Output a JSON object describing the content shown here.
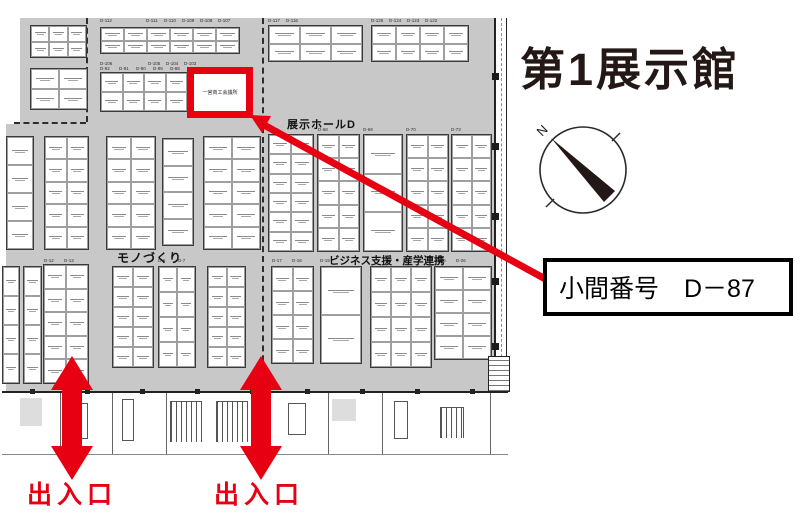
{
  "page": {
    "title": "第1展示館"
  },
  "compass": {
    "north_label": "N"
  },
  "callout": {
    "text": "小間番号　D－87"
  },
  "entrances": {
    "left_label": "出入口",
    "right_label": "出入口"
  },
  "aisles": {
    "hall_d": "展示ホールD",
    "monozukuri": "モノづくり",
    "business": "ビジネス支援・産学連携"
  },
  "highlighted_booth": {
    "number": "D－87",
    "name": "一宮商工会議所"
  },
  "colors": {
    "accent_red": "#e60012",
    "map_gray": "#c8c8c8",
    "ink": "#231815"
  },
  "map": {
    "groups": [
      {
        "x": 30,
        "y": 25,
        "w": 57,
        "h": 33,
        "c": 3,
        "r": 2
      },
      {
        "x": 30,
        "y": 68,
        "w": 58,
        "h": 42,
        "c": 2,
        "r": 2
      },
      {
        "x": 100,
        "y": 27,
        "w": 140,
        "h": 27,
        "c": 6,
        "r": 2
      },
      {
        "x": 100,
        "y": 72,
        "w": 88,
        "h": 40,
        "c": 4,
        "r": 2
      },
      {
        "x": 268,
        "y": 25,
        "w": 95,
        "h": 37,
        "c": 3,
        "r": 2
      },
      {
        "x": 371,
        "y": 25,
        "w": 98,
        "h": 37,
        "c": 4,
        "r": 2
      },
      {
        "x": 6,
        "y": 136,
        "w": 28,
        "h": 114,
        "c": 1,
        "r": 4
      },
      {
        "x": 44,
        "y": 136,
        "w": 45,
        "h": 114,
        "c": 2,
        "r": 5
      },
      {
        "x": 106,
        "y": 136,
        "w": 50,
        "h": 114,
        "c": 2,
        "r": 5
      },
      {
        "x": 162,
        "y": 138,
        "w": 32,
        "h": 108,
        "c": 1,
        "r": 4
      },
      {
        "x": 203,
        "y": 136,
        "w": 58,
        "h": 114,
        "c": 2,
        "r": 5
      },
      {
        "x": 268,
        "y": 134,
        "w": 46,
        "h": 118,
        "c": 2,
        "r": 6
      },
      {
        "x": 317,
        "y": 134,
        "w": 43,
        "h": 118,
        "c": 2,
        "r": 5
      },
      {
        "x": 363,
        "y": 134,
        "w": 40,
        "h": 118,
        "c": 1,
        "r": 3
      },
      {
        "x": 406,
        "y": 134,
        "w": 43,
        "h": 118,
        "c": 2,
        "r": 5
      },
      {
        "x": 451,
        "y": 134,
        "w": 41,
        "h": 118,
        "c": 2,
        "r": 5
      },
      {
        "x": 2,
        "y": 266,
        "w": 18,
        "h": 118,
        "c": 1,
        "r": 4
      },
      {
        "x": 23,
        "y": 266,
        "w": 19,
        "h": 118,
        "c": 1,
        "r": 4
      },
      {
        "x": 43,
        "y": 264,
        "w": 46,
        "h": 120,
        "c": 2,
        "r": 5
      },
      {
        "x": 112,
        "y": 266,
        "w": 42,
        "h": 102,
        "c": 2,
        "r": 5
      },
      {
        "x": 158,
        "y": 266,
        "w": 38,
        "h": 102,
        "c": 2,
        "r": 4
      },
      {
        "x": 207,
        "y": 266,
        "w": 39,
        "h": 102,
        "c": 2,
        "r": 5
      },
      {
        "x": 271,
        "y": 266,
        "w": 43,
        "h": 98,
        "c": 2,
        "r": 4
      },
      {
        "x": 320,
        "y": 266,
        "w": 42,
        "h": 98,
        "c": 1,
        "r": 2
      },
      {
        "x": 370,
        "y": 266,
        "w": 62,
        "h": 102,
        "c": 3,
        "r": 4
      },
      {
        "x": 434,
        "y": 266,
        "w": 58,
        "h": 94,
        "c": 2,
        "r": 4
      }
    ],
    "lot_numbers": [
      {
        "t": "D-112",
        "x": 100,
        "y": 19
      },
      {
        "t": "D-111",
        "x": 146,
        "y": 19
      },
      {
        "t": "D-110",
        "x": 164,
        "y": 19
      },
      {
        "t": "D-109",
        "x": 182,
        "y": 19
      },
      {
        "t": "D-108",
        "x": 200,
        "y": 19
      },
      {
        "t": "D-107",
        "x": 218,
        "y": 19
      },
      {
        "t": "D-117",
        "x": 268,
        "y": 19
      },
      {
        "t": "D-116",
        "x": 286,
        "y": 19
      },
      {
        "t": "D-125",
        "x": 371,
        "y": 19
      },
      {
        "t": "D-124",
        "x": 389,
        "y": 19
      },
      {
        "t": "D-123",
        "x": 407,
        "y": 19
      },
      {
        "t": "D-122",
        "x": 425,
        "y": 19
      },
      {
        "t": "D-106",
        "x": 100,
        "y": 62
      },
      {
        "t": "D-105",
        "x": 148,
        "y": 62
      },
      {
        "t": "D-104",
        "x": 166,
        "y": 62
      },
      {
        "t": "D-103",
        "x": 184,
        "y": 62
      },
      {
        "t": "D-92",
        "x": 100,
        "y": 67
      },
      {
        "t": "D-91",
        "x": 119,
        "y": 67
      },
      {
        "t": "D-90",
        "x": 136,
        "y": 67
      },
      {
        "t": "D-89",
        "x": 153,
        "y": 67
      },
      {
        "t": "D-88",
        "x": 170,
        "y": 67
      },
      {
        "t": "D-67",
        "x": 268,
        "y": 128
      },
      {
        "t": "D-68",
        "x": 318,
        "y": 128
      },
      {
        "t": "D-69",
        "x": 363,
        "y": 128
      },
      {
        "t": "D-70",
        "x": 406,
        "y": 128
      },
      {
        "t": "D-73",
        "x": 451,
        "y": 128
      },
      {
        "t": "D-17",
        "x": 272,
        "y": 259
      },
      {
        "t": "D-18",
        "x": 292,
        "y": 259
      },
      {
        "t": "D-19",
        "x": 320,
        "y": 259
      },
      {
        "t": "D-25",
        "x": 436,
        "y": 259
      },
      {
        "t": "D-26",
        "x": 456,
        "y": 259
      },
      {
        "t": "D-12",
        "x": 44,
        "y": 259
      },
      {
        "t": "D-13",
        "x": 64,
        "y": 259
      },
      {
        "t": "D-6",
        "x": 158,
        "y": 259
      },
      {
        "t": "D-7",
        "x": 178,
        "y": 259
      }
    ]
  }
}
